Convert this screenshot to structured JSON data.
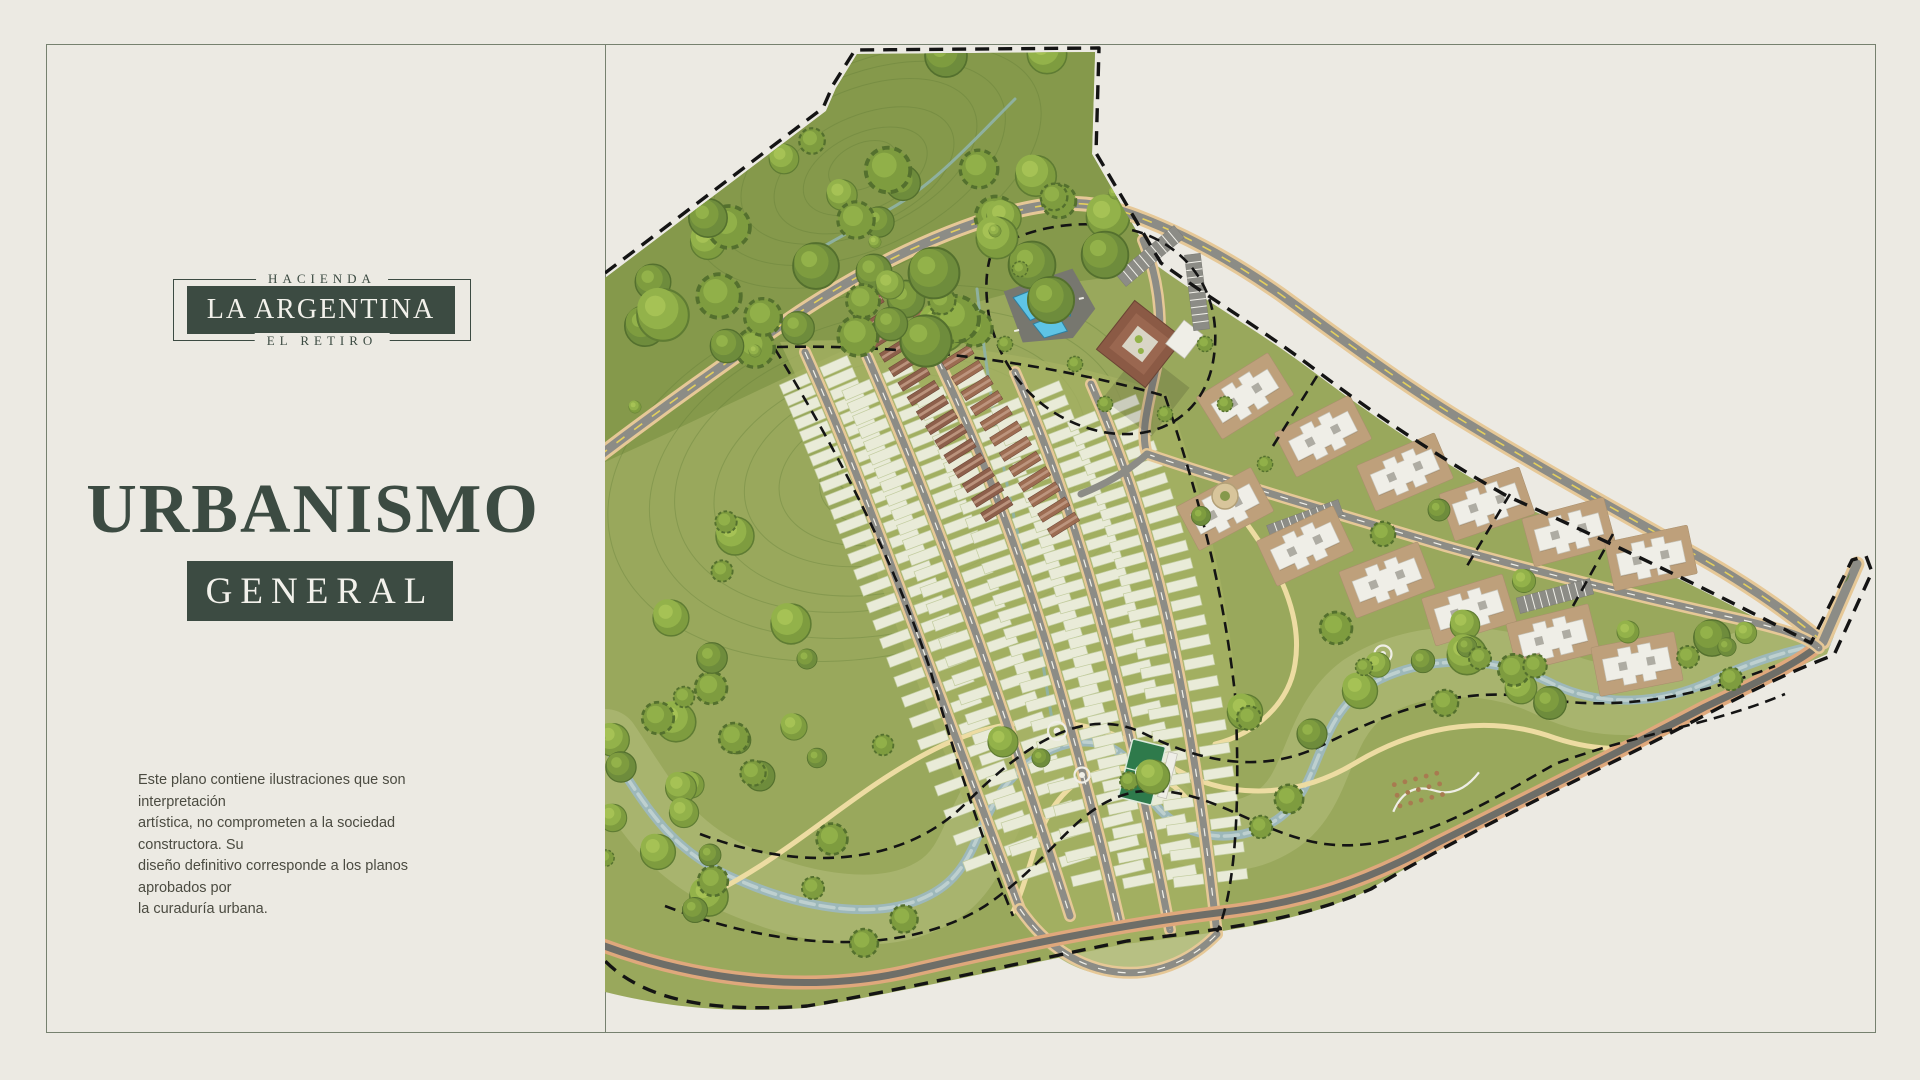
{
  "brand": {
    "top": "HACIENDA",
    "name": "LA ARGENTINA",
    "bottom": "EL RETIRO"
  },
  "title": {
    "main": "URBANISMO",
    "badge": "GENERAL"
  },
  "disclaimer": {
    "lines": [
      "Este plano contiene ilustraciones que son interpretación",
      "artística, no comprometen a la sociedad constructora. Su",
      "diseño definitivo corresponde a los planos aprobados por",
      "la curaduría urbana."
    ]
  },
  "map": {
    "features": [
      "property-boundary-dashed",
      "forest-hillside",
      "contour-lines",
      "main-road",
      "perimeter-road",
      "residential-lot-fan",
      "townhouse-rows",
      "clubhouse",
      "swimming-pools",
      "parking-strips",
      "condominium-buildings",
      "roundabout",
      "river",
      "stream",
      "walking-trails",
      "sports-field",
      "playground",
      "scattered-trees"
    ]
  },
  "palette": {
    "bg": "#ECEAE3",
    "frame": "#76816F",
    "ink": "#3C4B42",
    "text": "#4B4B41",
    "mapBase": "#99A85C",
    "mapForest": "#85994B",
    "mapLight": "#A5B163",
    "floodplain": "#B5BE7E",
    "contour": "#5E7836",
    "river": "#9DB8BA",
    "riverLight": "#C2D3D2",
    "trail": "#EDDCA2",
    "roadGray": "#8C8C86",
    "roadEdge": "#E6C897",
    "perimGray": "#6E6E68",
    "perimEdge": "#DFA87C",
    "laneWhite": "#F2F1EA",
    "centerYellow": "#E3CF5D",
    "lotFill": "#E9EBD8",
    "lotStroke": "#C2CC9E",
    "thRoof": "#8D5F4B",
    "thRoof2": "#9C6C52",
    "thRidge": "#C29B85",
    "condoWhite": "#EFEEE7",
    "condoPad": "#BEA07B",
    "roofGray": "#AEACA3",
    "poolBlue": "#5EC4E6",
    "poolPad": "#77776F",
    "clubRoof": "#8B5A45",
    "court": "#2E7A4B",
    "boundary": "#141414",
    "treeA": "#7E9C3F",
    "treeB": "#93B24A",
    "treeC": "#A9C457",
    "treeD": "#6E8C3C"
  }
}
